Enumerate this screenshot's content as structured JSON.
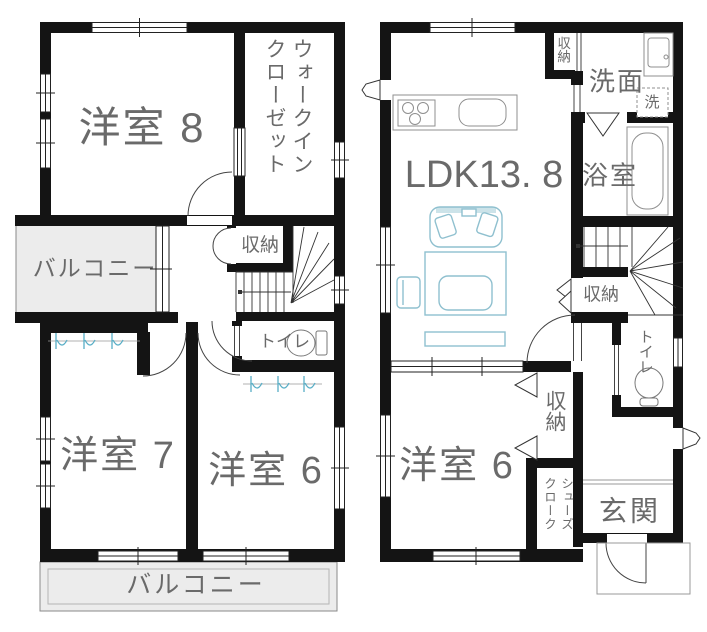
{
  "colors": {
    "wall": "#141414",
    "text": "#6a6a6a",
    "balcony": "#ececec",
    "furniture": "#8fc0cf",
    "fixture": "#8f8f8f",
    "closet_symbol": "#58aec6",
    "line": "#444444"
  },
  "floor2": {
    "room8": "洋室 8",
    "wic": "ウォークインクローゼット",
    "storage": "収納",
    "balcony_side": "バルコニー",
    "toilet": "トイレ",
    "room7": "洋室 7",
    "room6": "洋室 6",
    "balcony_bottom": "バルコニー"
  },
  "floor1": {
    "ldk": "LDK13. 8",
    "storage_top": "収納",
    "washroom": "洗面",
    "washer": "洗",
    "bath": "浴室",
    "storage_stairs": "収納",
    "toilet": "トイレ",
    "room6": "洋室 6",
    "closet": "収納",
    "shoes": "シューズクローク",
    "entrance": "玄関"
  }
}
